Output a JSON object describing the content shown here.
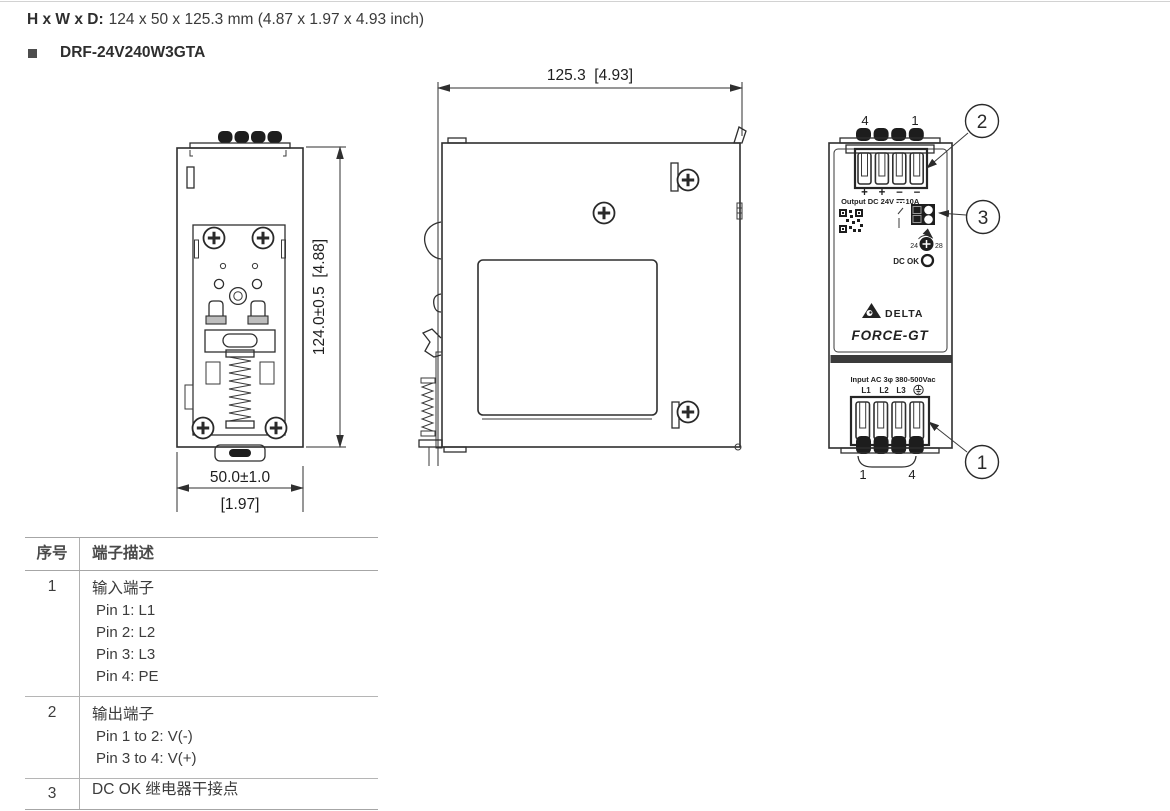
{
  "page": {
    "dims_label": "H x W x D:",
    "dims_value": "124 x 50 x 125.3 mm (4.87 x 1.97 x 4.93 inch)",
    "model": "DRF-24V240W3GTA"
  },
  "rear_view": {
    "height_dim": "124.0±0.5  [4.88]",
    "width_dim_mm": "50.0±1.0",
    "width_dim_inch": "[1.97]"
  },
  "side_view": {
    "depth_dim": "125.3  [4.93]"
  },
  "front_view": {
    "top_pin_left": "4",
    "top_pin_right": "1",
    "output_signs": [
      "+",
      "+",
      "−",
      "−"
    ],
    "output_label": "Output DC 24V",
    "output_current": "10A",
    "adjust_min": "24",
    "adjust_max": "28",
    "dc_ok": "DC OK",
    "brand": "DELTA",
    "series": "FORCE-GT",
    "input_label": "Input AC 3φ 380-500Vac",
    "input_pins": [
      "L1",
      "L2",
      "L3"
    ],
    "bottom_pin_left": "1",
    "bottom_pin_right": "4"
  },
  "callouts": {
    "c1": "1",
    "c2": "2",
    "c3": "3"
  },
  "table": {
    "col1": "序号",
    "col2": "端子描述",
    "rows": [
      {
        "num": "1",
        "title": "输入端子",
        "lines": [
          "Pin 1: L1",
          "Pin 2: L2",
          "Pin 3: L3",
          "Pin 4: PE"
        ]
      },
      {
        "num": "2",
        "title": "输出端子",
        "lines": [
          "Pin 1 to 2: V(-)",
          "Pin 3 to 4: V(+)"
        ]
      },
      {
        "num": "3",
        "title": "DC OK 继电器干接点",
        "lines": []
      }
    ]
  }
}
